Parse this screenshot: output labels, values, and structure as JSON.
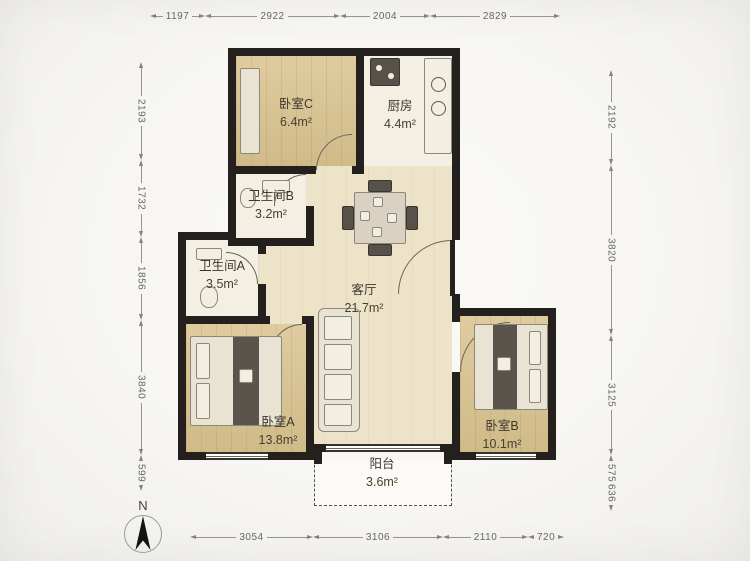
{
  "plan": {
    "compass": {
      "label": "N"
    },
    "rooms": [
      {
        "id": "bedroom-c",
        "name": "卧室C",
        "area": "6.4m²"
      },
      {
        "id": "kitchen",
        "name": "厨房",
        "area": "4.4m²"
      },
      {
        "id": "bathroom-b",
        "name": "卫生间B",
        "area": "3.2m²"
      },
      {
        "id": "bathroom-a",
        "name": "卫生间A",
        "area": "3.5m²"
      },
      {
        "id": "living-room",
        "name": "客厅",
        "area": "21.7m²"
      },
      {
        "id": "bedroom-a",
        "name": "卧室A",
        "area": "13.8m²"
      },
      {
        "id": "bedroom-b",
        "name": "卧室B",
        "area": "10.1m²"
      },
      {
        "id": "balcony",
        "name": "阳台",
        "area": "3.6m²"
      }
    ],
    "dimensions_mm": {
      "top": [
        "1197",
        "2922",
        "2004",
        "2829"
      ],
      "bottom": [
        "3054",
        "3106",
        "2110",
        "720"
      ],
      "left": [
        "2193",
        "1732",
        "1856",
        "3840",
        "599"
      ],
      "right": [
        "2192",
        "3820",
        "3125",
        "575",
        "636"
      ]
    },
    "colors": {
      "wall": "#23201d",
      "bedroom_floor": "#d9c28e",
      "living_floor": "#ece3c9",
      "service_floor": "#f3efe3",
      "background": "#f7f6f3"
    }
  }
}
